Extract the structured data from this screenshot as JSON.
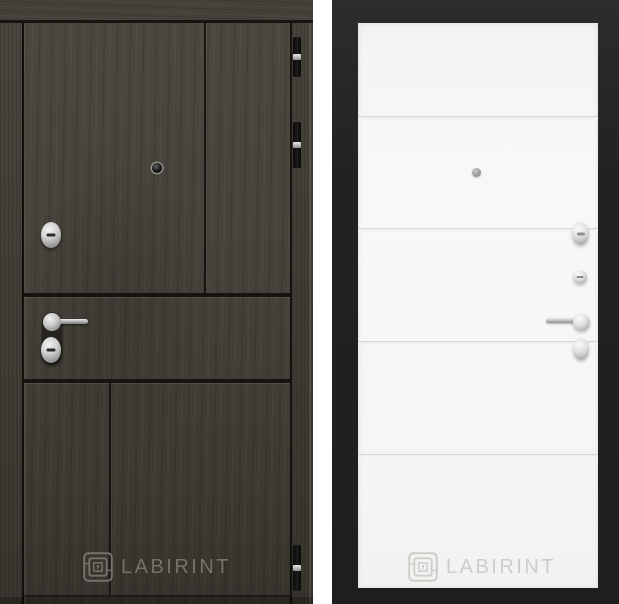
{
  "colors": {
    "page_bg": "#ffffff",
    "wood_base": "#46413a",
    "wood_dark": "#36332d",
    "seam": "#16140f",
    "frame": "#222222",
    "panel": "#f6f6f5",
    "groove": "#d7d7d5",
    "chrome": "#c8c8c8",
    "left_logo": "#75726c",
    "right_logo": "#cfccc9"
  },
  "left_door": {
    "brand_label": "LABIRINT",
    "logo_icon": "labyrinth-square",
    "hardware": [
      "peephole",
      "cylinder-lock",
      "lever-handle",
      "keyhole-escutcheon",
      "hinge",
      "hinge",
      "hinge"
    ]
  },
  "right_door": {
    "brand_label": "LABIRINT",
    "logo_icon": "labyrinth-square",
    "hardware": [
      "peephole",
      "thumbturn-knob",
      "cylinder-lock",
      "lever-handle",
      "keyhole-escutcheon"
    ]
  }
}
